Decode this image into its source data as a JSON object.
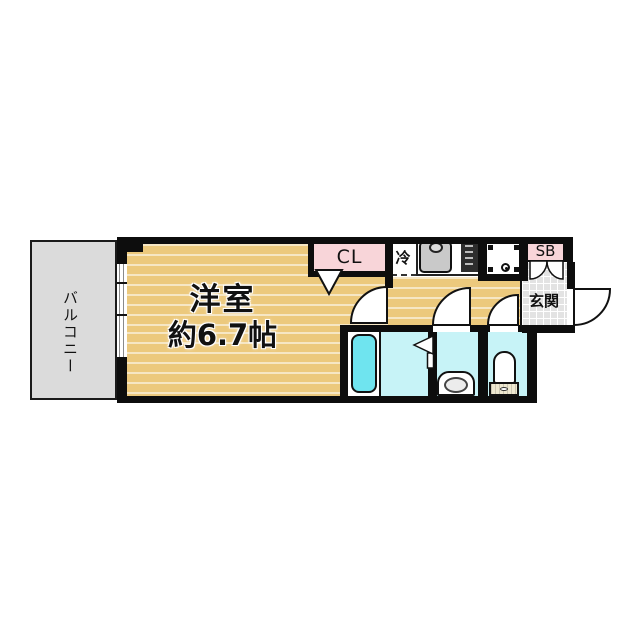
{
  "title": "apartment-floor-plan",
  "labels": {
    "balcony": "バルコニー",
    "room_name": "洋室",
    "room_size": "約6.7帖",
    "closet": "CL",
    "refrigerator": "冷",
    "shoe_box": "SB",
    "entrance": "玄関"
  },
  "rooms": [
    {
      "name": "バルコニー",
      "type": "balcony"
    },
    {
      "name": "洋室",
      "size": "約6.7帖",
      "type": "western-room"
    },
    {
      "name": "CL",
      "type": "closet"
    },
    {
      "name": "冷",
      "type": "refrigerator-space"
    },
    {
      "name": "SB",
      "type": "shoe-box"
    },
    {
      "name": "玄関",
      "type": "entrance"
    }
  ],
  "fixtures": [
    "bathtub",
    "bathroom-folding-door",
    "washbasin-vanity",
    "toilet",
    "kitchen-sink",
    "stove",
    "washing-machine-space",
    "sliding-window",
    "room-swing-door",
    "washroom-swing-door",
    "toilet-swing-door",
    "entrance-swing-door",
    "closet-door-marker",
    "shoe-box-doors"
  ],
  "colors": {
    "flooring": "#ECC97D",
    "flooring_stripe": "#F7EBC9",
    "balcony_gray": "#DBDBDB",
    "accent_pink": "#F8D5D9",
    "wet_room_cyan": "#C7F3F7",
    "bathtub_cyan": "#6FE4EF",
    "entrance_tile": "#E3E3E3",
    "wall_black": "#0D0D0D"
  }
}
